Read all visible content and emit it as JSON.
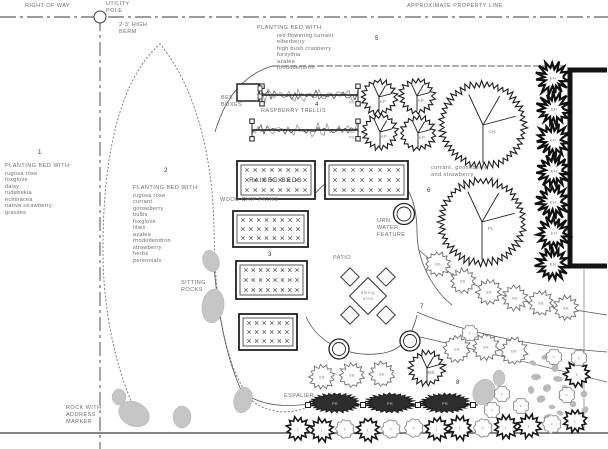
{
  "colors": {
    "ink": "#2b2b2b",
    "muted": "#6e6e6e",
    "light_line": "#b0b0b0",
    "rock": "#c6c6c6",
    "gravel": "#b9b9b9",
    "building": "#141414"
  },
  "labels": {
    "right_of_way": "RIGHT OF WAY",
    "utility_pole": "UTILITY\nPOLE",
    "approximate_property_line": "APPROXIMATE PROPERTY LINE",
    "high_berm": "2-3' HIGH\nBERM",
    "bee_boxes": "BEE\nBOXES",
    "raspberry_trellis": "RASPBERRY TRELLIS",
    "wood_chip_paths": "WOOD CHIP PATHS",
    "raised_beds": "RAISED BEDS",
    "sitting_rocks": "SITTING\nROCKS",
    "urn_water_feature": "URN\nWATER\nFEATURE",
    "patio": "PATIO",
    "dining_line1": "dining",
    "dining_line2": "area",
    "currant_note": "currant, gooseberry\nand strawberry",
    "espalier": "ESPALIER",
    "rock_with_address_marker": "ROCK WITH\nADDRESS\nMARKER"
  },
  "planting_beds": [
    {
      "num": "1",
      "title": "PLANTING BED WITH:",
      "plants": [
        "rugosa rose",
        "foxglove",
        "daisy",
        "rudebekia",
        "echinacea",
        "native strawberry",
        "grasses"
      ]
    },
    {
      "num": "2",
      "title": "PLANTING BED WITH:",
      "plants": [
        "rugosa rose",
        "currant",
        "gooseberry",
        "bulbs",
        "foxglove",
        "lilies",
        "azalea",
        "rhododendron",
        "strawberry",
        "herbs",
        "perennials"
      ]
    },
    {
      "num": "5",
      "title": "PLANTING BED WITH:",
      "plants": [
        "red flowering currant",
        "elberberry",
        "high bush cranberry",
        "forsythia",
        "azalea",
        "rhododendron"
      ]
    }
  ],
  "area_numbers": [
    {
      "n": "1",
      "x": 38,
      "y": 154
    },
    {
      "n": "2",
      "x": 164,
      "y": 172
    },
    {
      "n": "3",
      "x": 268,
      "y": 256
    },
    {
      "n": "4",
      "x": 315,
      "y": 106
    },
    {
      "n": "5",
      "x": 375,
      "y": 40
    },
    {
      "n": "6",
      "x": 427,
      "y": 192
    },
    {
      "n": "7",
      "x": 420,
      "y": 308
    },
    {
      "n": "8",
      "x": 456,
      "y": 384
    }
  ],
  "plan": {
    "raised_beds": [
      {
        "x": 237,
        "y": 161,
        "w": 78,
        "h": 38,
        "cols": 8,
        "rows": 3,
        "overlay": true
      },
      {
        "x": 325,
        "y": 161,
        "w": 83,
        "h": 38,
        "cols": 8,
        "rows": 3
      },
      {
        "x": 233,
        "y": 211,
        "w": 75,
        "h": 36,
        "cols": 8,
        "rows": 3
      },
      {
        "x": 236,
        "y": 261,
        "w": 71,
        "h": 38,
        "cols": 8,
        "rows": 3
      },
      {
        "x": 239,
        "y": 314,
        "w": 58,
        "h": 36,
        "cols": 6,
        "rows": 3
      }
    ],
    "trellis": {
      "end_code": "RB",
      "rows": [
        {
          "x1": 262,
          "x2": 358,
          "y": 95
        },
        {
          "x1": 252,
          "x2": 358,
          "y": 130
        }
      ]
    },
    "bee_box": {
      "x": 237,
      "y": 84,
      "w": 22,
      "h": 17
    },
    "espalier": {
      "y": 405,
      "x1": 308,
      "x2": 478,
      "posts": [
        308,
        363,
        418,
        473
      ],
      "shrubs": [
        335,
        390,
        445
      ],
      "code": "PR"
    },
    "symbols": [
      {
        "code": "AP",
        "type": "fruit",
        "x": 379,
        "y": 97,
        "r": 16
      },
      {
        "code": "AP",
        "type": "fruit",
        "x": 417,
        "y": 96,
        "r": 16
      },
      {
        "code": "AP",
        "type": "fruit",
        "x": 380,
        "y": 132,
        "r": 16
      },
      {
        "code": "AP",
        "type": "fruit",
        "x": 418,
        "y": 133,
        "r": 16
      },
      {
        "code": "CH",
        "type": "fruit",
        "x": 483,
        "y": 125,
        "r": 41
      },
      {
        "code": "PL",
        "type": "fruit",
        "x": 482,
        "y": 222,
        "r": 41
      },
      {
        "code": "MB",
        "type": "fruit",
        "x": 427,
        "y": 368,
        "r": 16
      },
      {
        "code": "EH",
        "type": "hedge",
        "x": 553,
        "y": 78,
        "r": 13
      },
      {
        "code": "EH",
        "type": "hedge",
        "x": 554,
        "y": 109,
        "r": 13
      },
      {
        "code": "EH",
        "type": "hedge",
        "x": 553,
        "y": 140,
        "r": 13
      },
      {
        "code": "EH",
        "type": "hedge",
        "x": 554,
        "y": 171,
        "r": 13
      },
      {
        "code": "EH",
        "type": "hedge",
        "x": 553,
        "y": 202,
        "r": 13
      },
      {
        "code": "EH",
        "type": "hedge",
        "x": 554,
        "y": 233,
        "r": 13
      },
      {
        "code": "EH",
        "type": "hedge",
        "x": 553,
        "y": 264,
        "r": 13
      },
      {
        "code": "BB",
        "type": "bushL",
        "x": 438,
        "y": 264,
        "r": 11
      },
      {
        "code": "BB",
        "type": "bushL",
        "x": 463,
        "y": 281,
        "r": 11
      },
      {
        "code": "BB",
        "type": "bushL",
        "x": 489,
        "y": 292,
        "r": 11
      },
      {
        "code": "BB",
        "type": "bushL",
        "x": 515,
        "y": 298,
        "r": 11
      },
      {
        "code": "BB",
        "type": "bushL",
        "x": 541,
        "y": 303,
        "r": 11
      },
      {
        "code": "BB",
        "type": "bushL",
        "x": 566,
        "y": 308,
        "r": 11
      },
      {
        "code": "BB",
        "type": "bushL",
        "x": 457,
        "y": 349,
        "r": 12
      },
      {
        "code": "BB",
        "type": "bushL",
        "x": 486,
        "y": 347,
        "r": 12
      },
      {
        "code": "BB",
        "type": "bushL",
        "x": 514,
        "y": 351,
        "r": 12
      },
      {
        "code": "BB",
        "type": "bushL",
        "x": 322,
        "y": 377,
        "r": 11
      },
      {
        "code": "BB",
        "type": "bushL",
        "x": 352,
        "y": 375,
        "r": 11
      },
      {
        "code": "BB",
        "type": "bushL",
        "x": 382,
        "y": 374,
        "r": 11
      },
      {
        "code": "L",
        "type": "bushD",
        "x": 298,
        "y": 429,
        "r": 10
      },
      {
        "code": "L",
        "type": "bushD",
        "x": 322,
        "y": 430,
        "r": 10
      },
      {
        "code": "F",
        "type": "fluff",
        "x": 345,
        "y": 429,
        "r": 8
      },
      {
        "code": "L",
        "type": "bushD",
        "x": 368,
        "y": 430,
        "r": 10
      },
      {
        "code": "F",
        "type": "fluff",
        "x": 391,
        "y": 429,
        "r": 8
      },
      {
        "code": "F",
        "type": "fluff",
        "x": 414,
        "y": 428,
        "r": 8
      },
      {
        "code": "L",
        "type": "bushD",
        "x": 437,
        "y": 429,
        "r": 10
      },
      {
        "code": "L",
        "type": "bushD",
        "x": 460,
        "y": 428,
        "r": 10
      },
      {
        "code": "F",
        "type": "fluff",
        "x": 483,
        "y": 428,
        "r": 8
      },
      {
        "code": "L",
        "type": "bushD",
        "x": 506,
        "y": 427,
        "r": 10
      },
      {
        "code": "L",
        "type": "bushD",
        "x": 529,
        "y": 426,
        "r": 10
      },
      {
        "code": "F",
        "type": "fluff",
        "x": 552,
        "y": 424,
        "r": 8
      },
      {
        "code": "L",
        "type": "bushD",
        "x": 575,
        "y": 421,
        "r": 10
      },
      {
        "code": "L",
        "type": "bushD",
        "x": 577,
        "y": 374,
        "r": 11
      },
      {
        "code": "F",
        "type": "fluff",
        "x": 502,
        "y": 394,
        "r": 7
      },
      {
        "code": "F",
        "type": "fluff",
        "x": 492,
        "y": 410,
        "r": 7
      },
      {
        "code": "F",
        "type": "fluff",
        "x": 521,
        "y": 406,
        "r": 7
      },
      {
        "code": "F",
        "type": "fluff",
        "x": 554,
        "y": 357,
        "r": 7
      },
      {
        "code": "F",
        "type": "fluff",
        "x": 567,
        "y": 395,
        "r": 7
      },
      {
        "code": "F",
        "type": "fluff",
        "x": 579,
        "y": 358,
        "r": 7
      },
      {
        "code": "F",
        "type": "fluff",
        "x": 470,
        "y": 333,
        "r": 7
      }
    ],
    "rocks": [
      [
        211,
        261,
        8,
        11,
        -20
      ],
      [
        213,
        306,
        11,
        17,
        8
      ],
      [
        119,
        397,
        7,
        8,
        0
      ],
      [
        134,
        414,
        16,
        12,
        25
      ],
      [
        182,
        417,
        9,
        11,
        0
      ],
      [
        243,
        400,
        9,
        13,
        15
      ],
      [
        484,
        392,
        11,
        13,
        20
      ],
      [
        499,
        378,
        6,
        8,
        0
      ]
    ],
    "gravel": [
      [
        533,
        363
      ],
      [
        545,
        357
      ],
      [
        555,
        368
      ],
      [
        536,
        377
      ],
      [
        547,
        388
      ],
      [
        558,
        379
      ],
      [
        541,
        399
      ],
      [
        552,
        407
      ],
      [
        563,
        397
      ],
      [
        531,
        390
      ],
      [
        560,
        413
      ],
      [
        548,
        418
      ],
      [
        566,
        388
      ],
      [
        573,
        404
      ],
      [
        585,
        410
      ],
      [
        584,
        394
      ]
    ]
  }
}
